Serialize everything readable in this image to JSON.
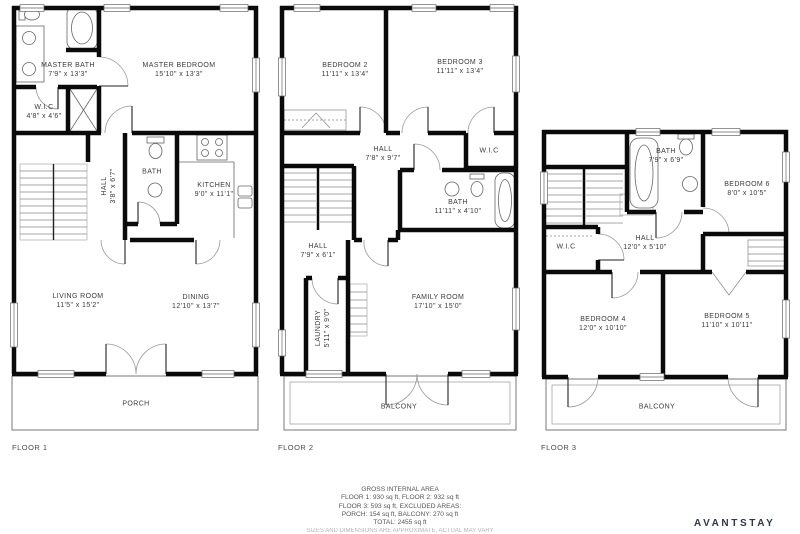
{
  "brand": {
    "name": "AVANTSTAY",
    "color": "#2c3748"
  },
  "colors": {
    "wall": "#0a0a0a",
    "thin_line": "#555555",
    "label_text": "#3b3b3b"
  },
  "floors": [
    {
      "label": "FLOOR 1",
      "rooms": [
        {
          "name": "MASTER BATH",
          "dims": "7'9\" x 13'3\""
        },
        {
          "name": "MASTER BEDROOM",
          "dims": "15'10\" x 13'3\""
        },
        {
          "name": "W.I.C",
          "dims": "4'8\" x 4'6\""
        },
        {
          "name": "HALL",
          "dims": "3'8\" x 6'7\""
        },
        {
          "name": "BATH",
          "dims": ""
        },
        {
          "name": "KITCHEN",
          "dims": "9'0\" x 11'1\""
        },
        {
          "name": "LIVING ROOM",
          "dims": "11'5\" x 15'2\""
        },
        {
          "name": "DINING",
          "dims": "12'10\" x 13'7\""
        },
        {
          "name": "PORCH",
          "dims": ""
        }
      ]
    },
    {
      "label": "FLOOR 2",
      "rooms": [
        {
          "name": "BEDROOM 2",
          "dims": "11'11\" x 13'4\""
        },
        {
          "name": "BEDROOM 3",
          "dims": "11'11\" x 13'4\""
        },
        {
          "name": "HALL",
          "dims": "7'8\" x 9'7\""
        },
        {
          "name": "W.I.C",
          "dims": ""
        },
        {
          "name": "BATH",
          "dims": "11'11\" x 4'10\""
        },
        {
          "name": "HALL",
          "dims": "7'9\" x 6'1\""
        },
        {
          "name": "LAUNDRY",
          "dims": "5'11\" x 9'0\""
        },
        {
          "name": "FAMILY ROOM",
          "dims": "17'10\" x 15'0\""
        },
        {
          "name": "BALCONY",
          "dims": ""
        }
      ]
    },
    {
      "label": "FLOOR 3",
      "rooms": [
        {
          "name": "BATH",
          "dims": "7'9\" x 6'9\""
        },
        {
          "name": "BEDROOM 6",
          "dims": "8'0\" x 10'5\""
        },
        {
          "name": "HALL",
          "dims": "12'0\" x 5'10\""
        },
        {
          "name": "W.I.C",
          "dims": ""
        },
        {
          "name": "BEDROOM 4",
          "dims": "12'0\" x 10'10\""
        },
        {
          "name": "BEDROOM 5",
          "dims": "11'10\" x 10'11\""
        },
        {
          "name": "BALCONY",
          "dims": ""
        }
      ]
    }
  ],
  "footer": {
    "line1": "GROSS INTERNAL AREA",
    "line2": "FLOOR 1: 930 sq ft, FLOOR 2: 932 sq ft",
    "line3": "FLOOR 3: 593 sq ft, EXCLUDED AREAS:",
    "line4": "PORCH: 154 sq ft, BALCONY: 270 sq ft",
    "line5": "TOTAL: 2455 sq ft",
    "line6": "SIZES AND DIMENSIONS ARE APPROXIMATE, ACTUAL MAY VARY"
  }
}
